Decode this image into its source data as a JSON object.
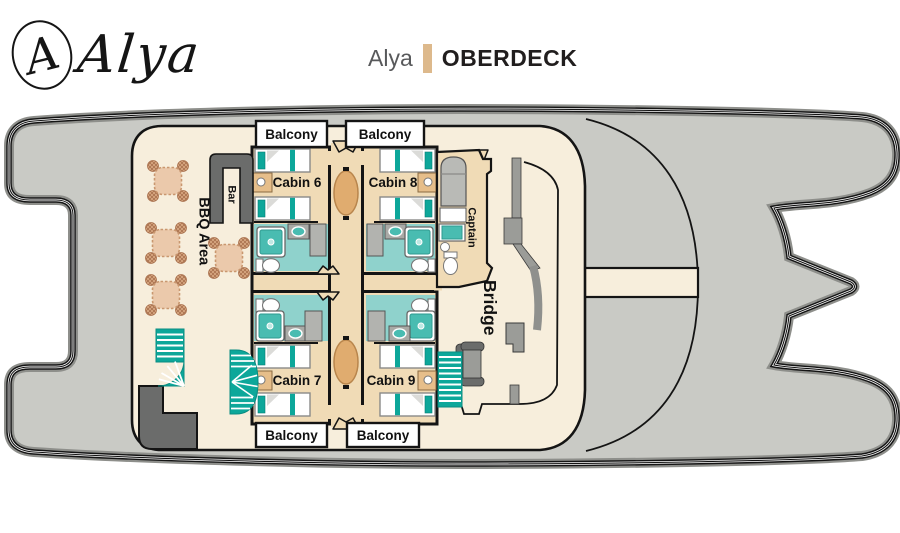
{
  "header": {
    "logo_monogram": "A",
    "logo_name": "Alya",
    "title_ship": "Alya",
    "title_deck": "OBERDECK"
  },
  "plan": {
    "balconies": [
      "Balcony",
      "Balcony",
      "Balcony",
      "Balcony"
    ],
    "cabins": [
      {
        "label": "Cabin 6"
      },
      {
        "label": "Cabin 8"
      },
      {
        "label": "Cabin 7"
      },
      {
        "label": "Cabin 9"
      }
    ],
    "areas": {
      "bbq": "BBQ Area",
      "bar": "Bar",
      "captain": "Captain",
      "bridge": "Bridge"
    },
    "colors": {
      "hull": "#C9CAC5",
      "deckhouse": "#F7EEDC",
      "corridor": "#F0DBB6",
      "bathroom": "#8FD2CC",
      "teal": "#0DA79A",
      "dark_gray": "#6B6C6B",
      "table_wood": "#E0AC6F",
      "title_divider": "#DDB98C"
    }
  }
}
